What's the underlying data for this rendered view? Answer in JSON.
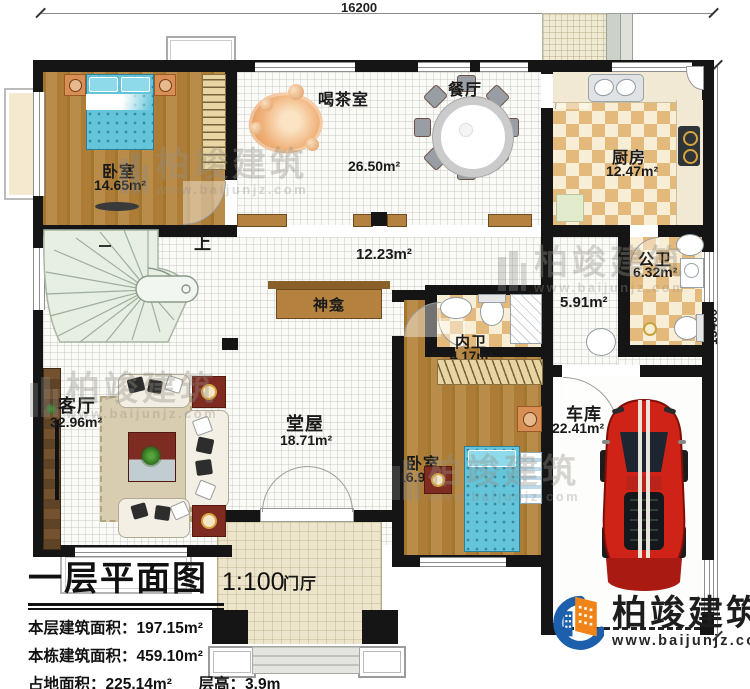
{
  "plan": {
    "dimensions": {
      "top": "16200",
      "right": "13400"
    },
    "rooms": {
      "bedroom1": {
        "name": "卧室",
        "area": "14.65m²"
      },
      "tea_room": {
        "name": "喝茶室",
        "area": "26.50m²"
      },
      "dining": {
        "name": "餐厅"
      },
      "kitchen": {
        "name": "厨房",
        "area": "12.47m²"
      },
      "public_bath": {
        "name": "公卫",
        "area": "6.32m²"
      },
      "corridor": {
        "area": "5.91m²"
      },
      "hallway": {
        "area": "12.23m²"
      },
      "ensuite": {
        "name": "内卫",
        "area": "4.17m²"
      },
      "bedroom2": {
        "name": "卧室",
        "area": "16.98m²"
      },
      "garage": {
        "name": "车库",
        "area": "22.41m²"
      },
      "living": {
        "name": "客厅",
        "area": "32.96m²"
      },
      "main_hall": {
        "name": "堂屋",
        "area": "18.71m²"
      },
      "shrine": {
        "name": "神龛"
      },
      "foyer": {
        "name": "门厅"
      },
      "stairs": {
        "label": "上"
      }
    }
  },
  "title_block": {
    "title": "一层平面图",
    "scale": "1:100",
    "stats": [
      {
        "label": "本层建筑面积：",
        "value": "197.15m²"
      },
      {
        "label": "本栋建筑面积：",
        "value": "459.10m²"
      },
      {
        "label": "占地面积：",
        "value": "225.14m²"
      },
      {
        "label": "层高：",
        "value": "3.9m"
      }
    ]
  },
  "logo": {
    "name": "柏竣建筑",
    "url": "www.baijunjz.com"
  },
  "watermark": {
    "name": "柏竣建筑",
    "url": "www.baijunjz.com"
  },
  "colors": {
    "wall": "#151515",
    "wood": "#ad7e3d",
    "checker": "#e3b97c",
    "bed": "#63c4da",
    "stairs": "#e6efe2",
    "foyer_tile": "#ece4cb",
    "car_red": "#d02318",
    "logo_blue": "#1b5fad",
    "logo_orange": "#f08419"
  }
}
